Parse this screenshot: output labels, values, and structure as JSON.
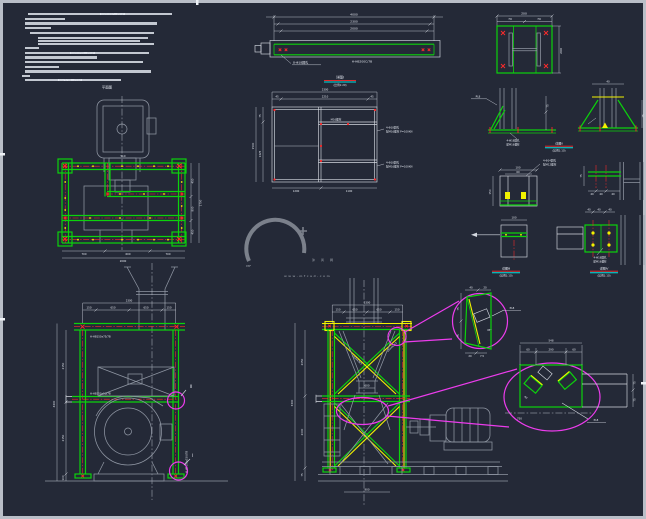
{
  "palette": {
    "background": "#242937",
    "border": "#b9bec7",
    "green": "#0cd20c",
    "yellow": "#f2f200",
    "red": "#ff2a2a",
    "magenta": "#ec3cec",
    "cyan": "#00e4e4",
    "gray_line": "#8f96a3",
    "white_line": "#d5d9e1",
    "watermark_gray": "#878d97"
  },
  "watermark": {
    "logo": "MF",
    "brand": "沐风网",
    "url": "www.mfcad.com"
  },
  "notes": {
    "rows": [
      [
        28,
        13,
        144
      ],
      [
        25,
        17.7,
        40
      ],
      [
        25,
        22.4,
        132
      ],
      [
        25,
        27.1,
        26
      ],
      [
        30,
        31.8,
        124
      ],
      [
        38,
        36.5,
        110
      ],
      [
        38,
        39.7,
        102
      ],
      [
        38,
        42.9,
        116
      ],
      [
        25,
        46.8,
        14
      ],
      [
        25,
        51.5,
        124
      ],
      [
        25,
        56.2,
        72
      ],
      [
        25,
        60.9,
        118
      ],
      [
        25,
        65.6,
        34
      ],
      [
        25,
        70.3,
        126
      ],
      [
        22,
        75,
        8
      ],
      [
        25,
        79,
        96
      ]
    ],
    "codes": [
      "GB50017—2012",
      "GB50756—2012",
      "GB/T709—2012"
    ]
  },
  "titles": {
    "beam": {
      "name": "详图Ⅰ",
      "scale": "(比例1:20)"
    },
    "t1": {
      "name": "详图Ⅱ",
      "scale": "(比例1:10)"
    },
    "t2": {
      "name": "详图Ⅲ",
      "scale": "(比例1:10)"
    },
    "t3": {
      "name": "详图Ⅳ",
      "scale": "(比例1:10)"
    }
  },
  "labels": {
    "tl_title": "平面图",
    "beam_mark": "H-HB200C/7B",
    "beam_holes": "8-Φ18圆孔",
    "top_beam_mark": "H-HB150x75/7B",
    "mid_beam_mark": "H-HB150x50/7B",
    "col_mark": "H-HB150x150/7B",
    "brace_mark": "L63x63x5",
    "pl8": "PL8",
    "bolt_note": "M16螺栓",
    "holes1": [
      "4-Φ18圆孔",
      "配M16螺栓 P=100KN"
    ],
    "holes2": [
      "4-Φ18圆孔",
      "配M16螺栓 P=100KN"
    ],
    "holes_a": [
      "4-Φ18圆孔",
      "配M16螺栓"
    ],
    "holes_b": [
      "4-Φ18圆孔",
      "配M16螺栓"
    ],
    "holes_c": [
      "4-Φ14圆孔",
      "配M12螺栓"
    ],
    "callout_I": "Ⅰ",
    "callout_II": "Ⅱ",
    "angle": "45°"
  },
  "dims": {
    "beam": [
      "4000",
      "2300",
      "2000"
    ],
    "plate": [
      "200",
      "70",
      "70",
      "200"
    ],
    "det_c": [
      "100",
      "60",
      "150"
    ],
    "det_d": [
      "40",
      "40",
      "40",
      "75"
    ],
    "det_e": [
      "100"
    ],
    "det_f": [
      "40",
      "40",
      "40"
    ],
    "lplan_top": "510",
    "lplan_right": [
      "450",
      "800",
      "450",
      "1700"
    ],
    "lplan_bottom": [
      "700",
      "600",
      "700",
      "2000"
    ],
    "cplan_top": [
      "2300",
      "45",
      "2210",
      "45"
    ],
    "cplan_left": [
      "75",
      "1425",
      "1500"
    ],
    "cplan_bottom": [
      "1200",
      "1100"
    ],
    "blelev_top": [
      "2300",
      "150",
      "650",
      "650",
      "150"
    ],
    "blelev_left": [
      "4400",
      "2150",
      "2150",
      "100"
    ],
    "bcelev_top": [
      "2300",
      "150",
      "650",
      "650",
      "150"
    ],
    "bcelev_left": [
      "3300",
      "2050",
      "2000",
      "75"
    ],
    "bcelev_small": [
      "600",
      "900"
    ],
    "det1": [
      "40",
      "20",
      "75",
      "75",
      "20",
      "7.5"
    ],
    "det2": [
      "548",
      "60",
      "290",
      "60",
      "75",
      "75",
      "750"
    ]
  }
}
